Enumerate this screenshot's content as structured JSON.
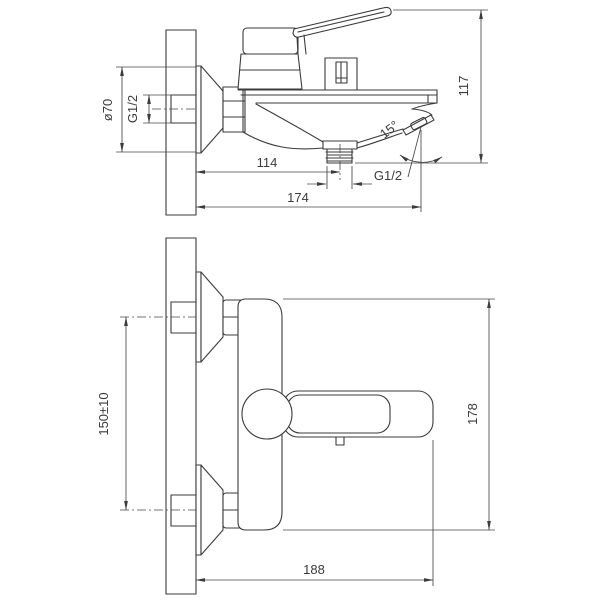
{
  "drawing": {
    "type": "technical-drawing",
    "subject": "wall-mounted bath mixer faucet, two orthographic views with dimensions",
    "units_note": "mm (implied)",
    "line_color": "#3b3b3b",
    "background": "#ffffff",
    "labels": {
      "side_view": {
        "flange_diameter": "ø70",
        "wall_thread": "G1/2",
        "spout_height": "117",
        "outlet_offset": "114",
        "outlet_thread": "G1/2",
        "total_reach": "174",
        "spout_angle": "15°"
      },
      "front_view": {
        "connection_centers": "150±10",
        "body_height": "178",
        "total_width": "188"
      }
    }
  }
}
